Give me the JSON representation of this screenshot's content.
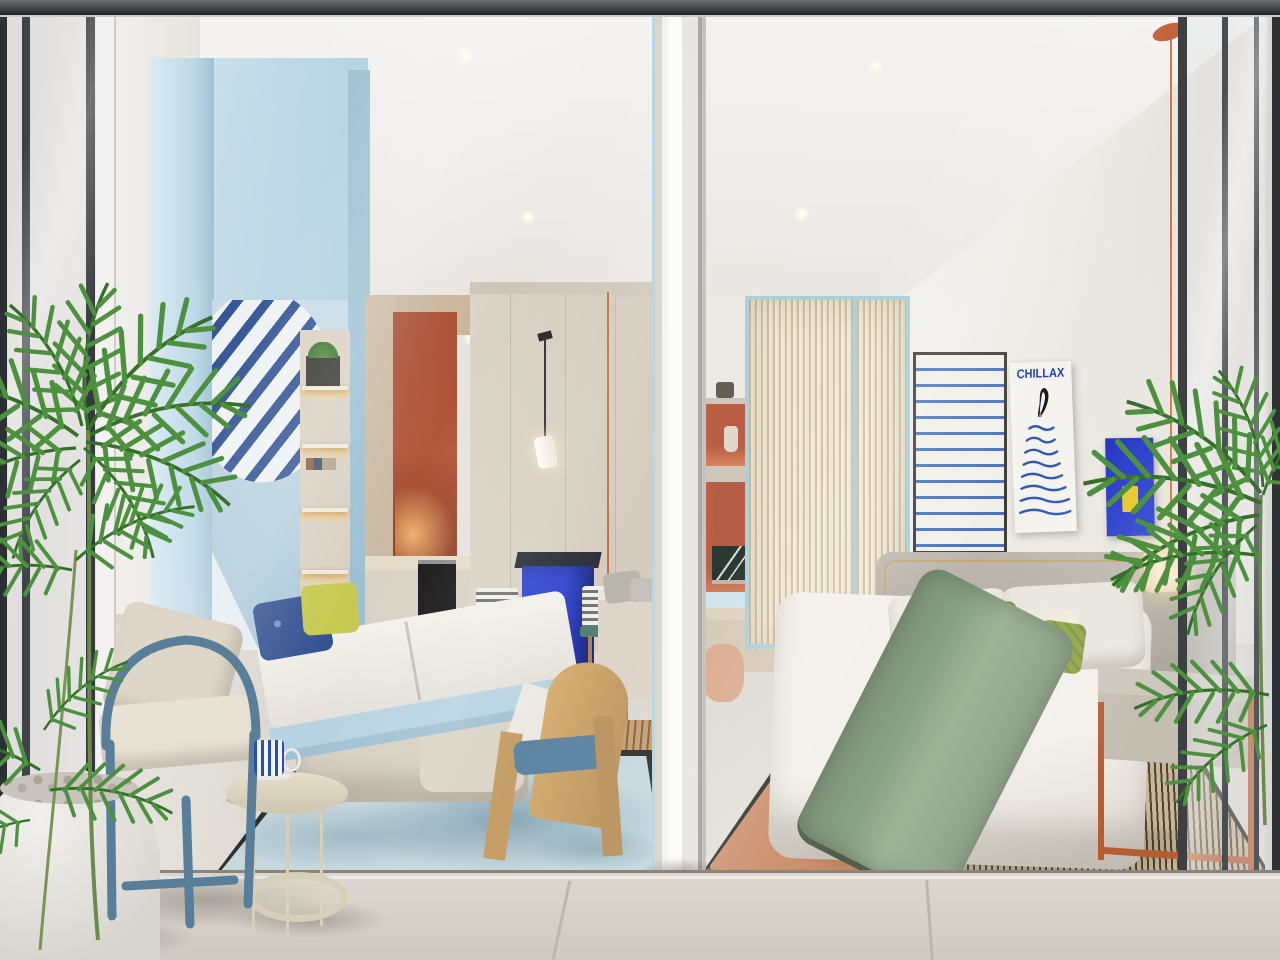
{
  "scene": {
    "description": "Photorealistic 3D render of two adjacent studio apartments viewed from a shared balcony through an open glass facade",
    "style": "architectural interior visualization",
    "rooms": [
      "left-studio",
      "right-studio"
    ]
  },
  "left_room": {
    "objects": [
      "light-blue murphy-bed cabinet with palm-leaf mural",
      "fold-down double bed with white mattress",
      "sofa beneath murphy bed",
      "kitchenette with terracotta backsplash and under-cabinet light",
      "black built-in oven",
      "cobalt-blue bar island",
      "two wooden bar stools with striped cushions",
      "black-stem pendant lamp with white shade",
      "beige wardrobe with orange trim line",
      "orange wall box shelf with potted plant",
      "floating shelves with penguin figurines",
      "curved wooden chair with blue seat cushion",
      "console with grey cushions",
      "light-blue spotted rug with dark border",
      "woven jute mat"
    ],
    "pillow_colors": [
      "navy patterned",
      "chartreuse"
    ]
  },
  "right_room": {
    "poster_text": "CHILLAX",
    "objects": [
      "double bed with grey upholstered headboard and brass piping",
      "sage-green throw blanket",
      "CHILLAX penguin poster",
      "cobalt-blue wall panel with yellow card",
      "framed blue wave artwork",
      "fluted champagne-glass wardrobe partition with light-blue frames",
      "terracotta display niches with vase and palm-art laptop",
      "built-in desk with peach pouf",
      "pendant light with orange cord and cream shade",
      "console bench with orange metal frame",
      "striped rug with terracotta runner and sage panel"
    ],
    "pillow_colors": [
      "white",
      "white",
      "orange-green",
      "cream",
      "green striped"
    ]
  },
  "balcony": {
    "objects": [
      "steel-blue tube-frame armchair with cream cushions",
      "round cream side table with lower tray",
      "blue-striped mug on saucer",
      "white planter with pebbles",
      "areca palm fronds left and right"
    ]
  },
  "palette": {
    "murphy_unit_blue": "#bcd8e6",
    "terracotta": "#b2563a",
    "cobalt_island": "#2338c2",
    "poster_blue": "#1c3bb0",
    "sage_throw": "#8da387",
    "rug_blue": "#c6d7dd",
    "rug_terracotta": "#c98a66",
    "rug_green": "#a6ba92",
    "floor_grey": "#d6d1ca",
    "mullion_dark": "#3c4043",
    "palm_green": "#4d9140",
    "orange_accent": "#c4683c",
    "yellow_card": "#e7c520"
  }
}
